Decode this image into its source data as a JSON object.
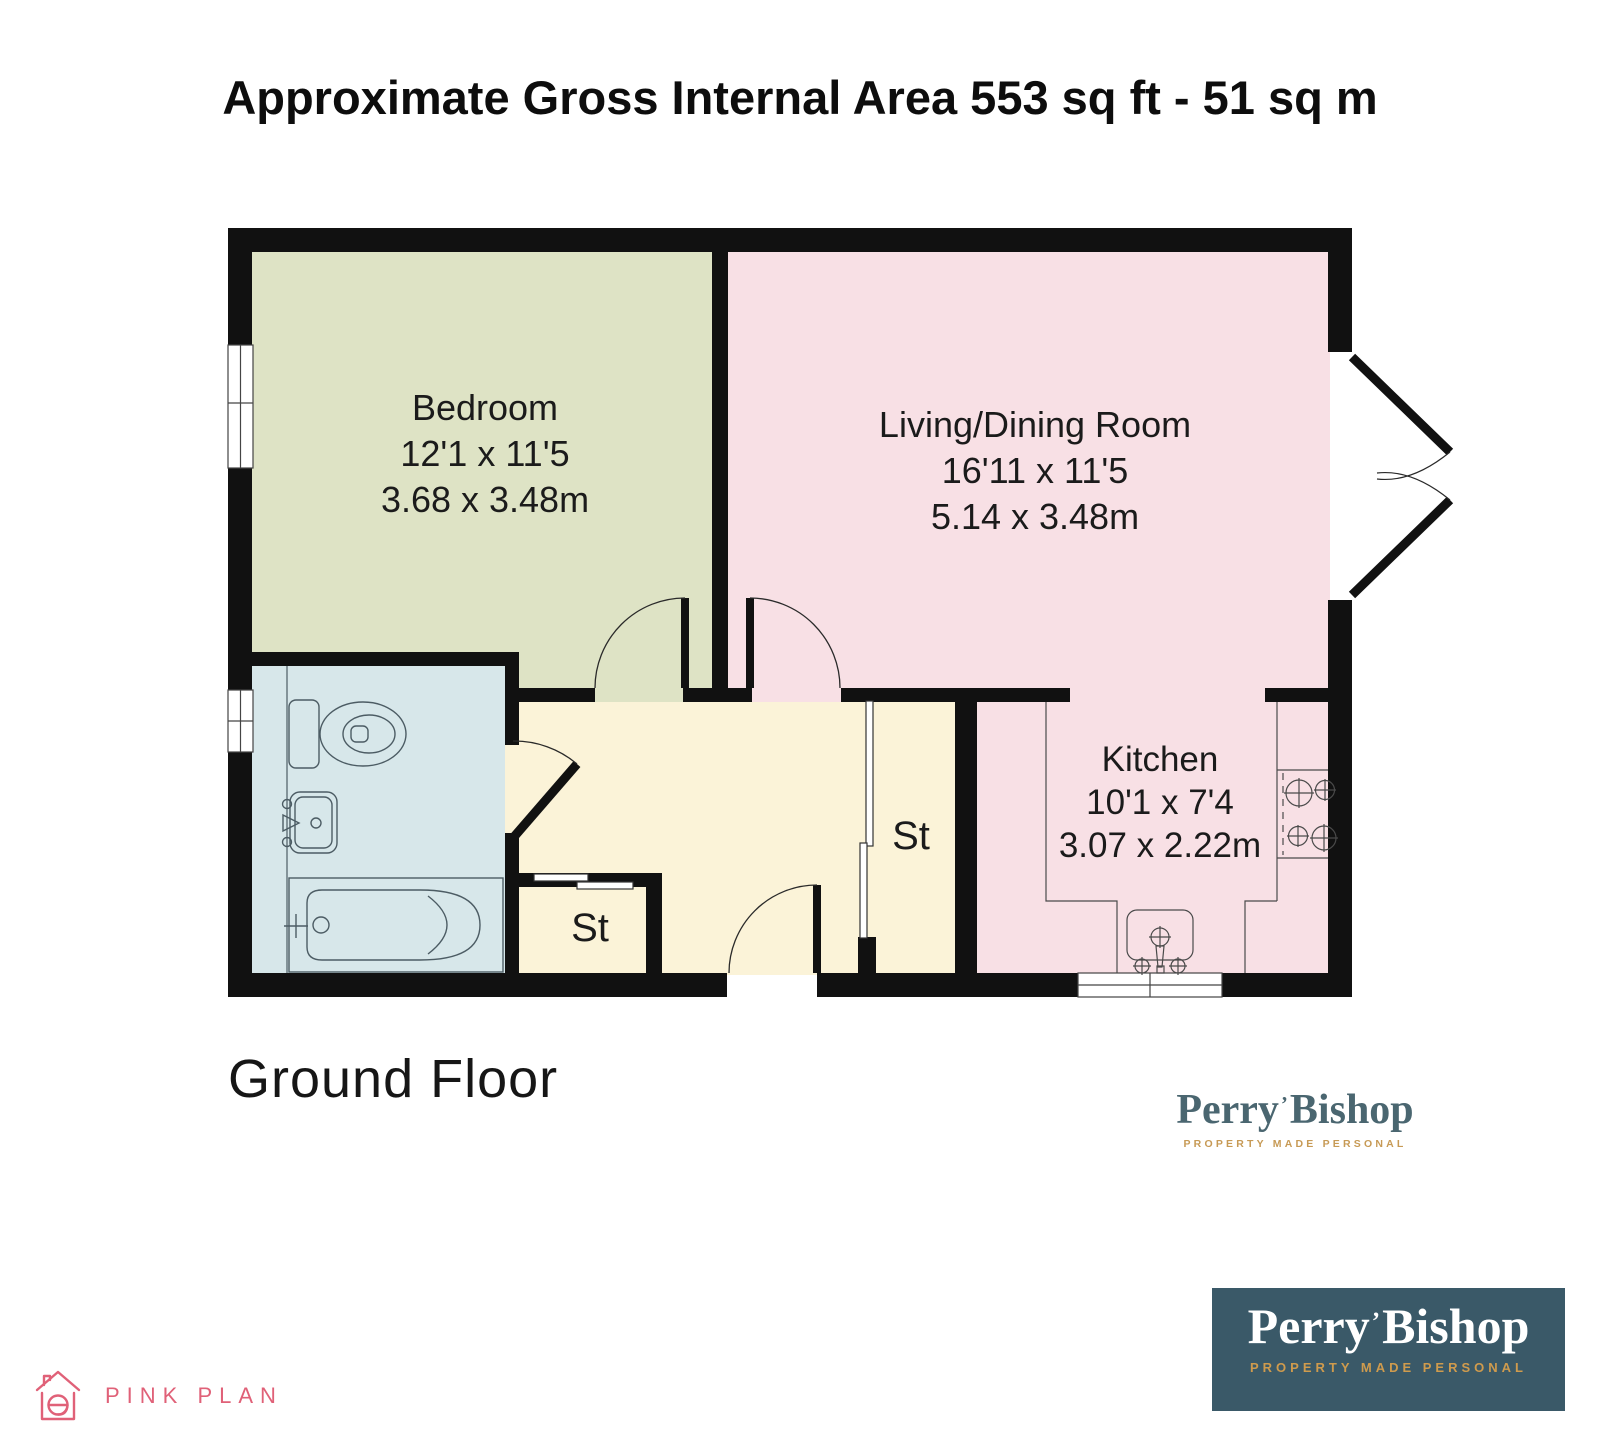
{
  "title": "Approximate Gross Internal Area 553 sq ft - 51 sq m",
  "floor": {
    "label": "Ground Floor"
  },
  "plan": {
    "rooms": {
      "bedroom": {
        "name": "Bedroom",
        "size_imperial": "12'1 x 11'5",
        "size_metric": "3.68 x 3.48m"
      },
      "living_dining": {
        "name": "Living/Dining Room",
        "size_imperial": "16'11 x 11'5",
        "size_metric": "5.14 x 3.48m"
      },
      "kitchen": {
        "name": "Kitchen",
        "size_imperial": "10'1 x 7'4",
        "size_metric": "3.07 x 2.22m"
      },
      "storage_left": {
        "abbr": "St"
      },
      "storage_right": {
        "abbr": "St"
      }
    }
  },
  "branding": {
    "agency": {
      "word_left": "Perry",
      "word_mark": "’",
      "word_right": "Bishop",
      "tagline": "PROPERTY MADE PERSONAL"
    },
    "plan_credit": {
      "name": "PINK PLAN"
    }
  },
  "colors": {
    "bedroom_fill": "#dee3c5",
    "living_fill": "#f8e0e5",
    "bathroom_fill": "#d7e7ea",
    "hallway_fill": "#fbf3d8",
    "wall": "#111111",
    "agency_teal": "#3a5968",
    "agency_gold": "#cf9b4d",
    "plan_credit_pink": "#e06178"
  }
}
